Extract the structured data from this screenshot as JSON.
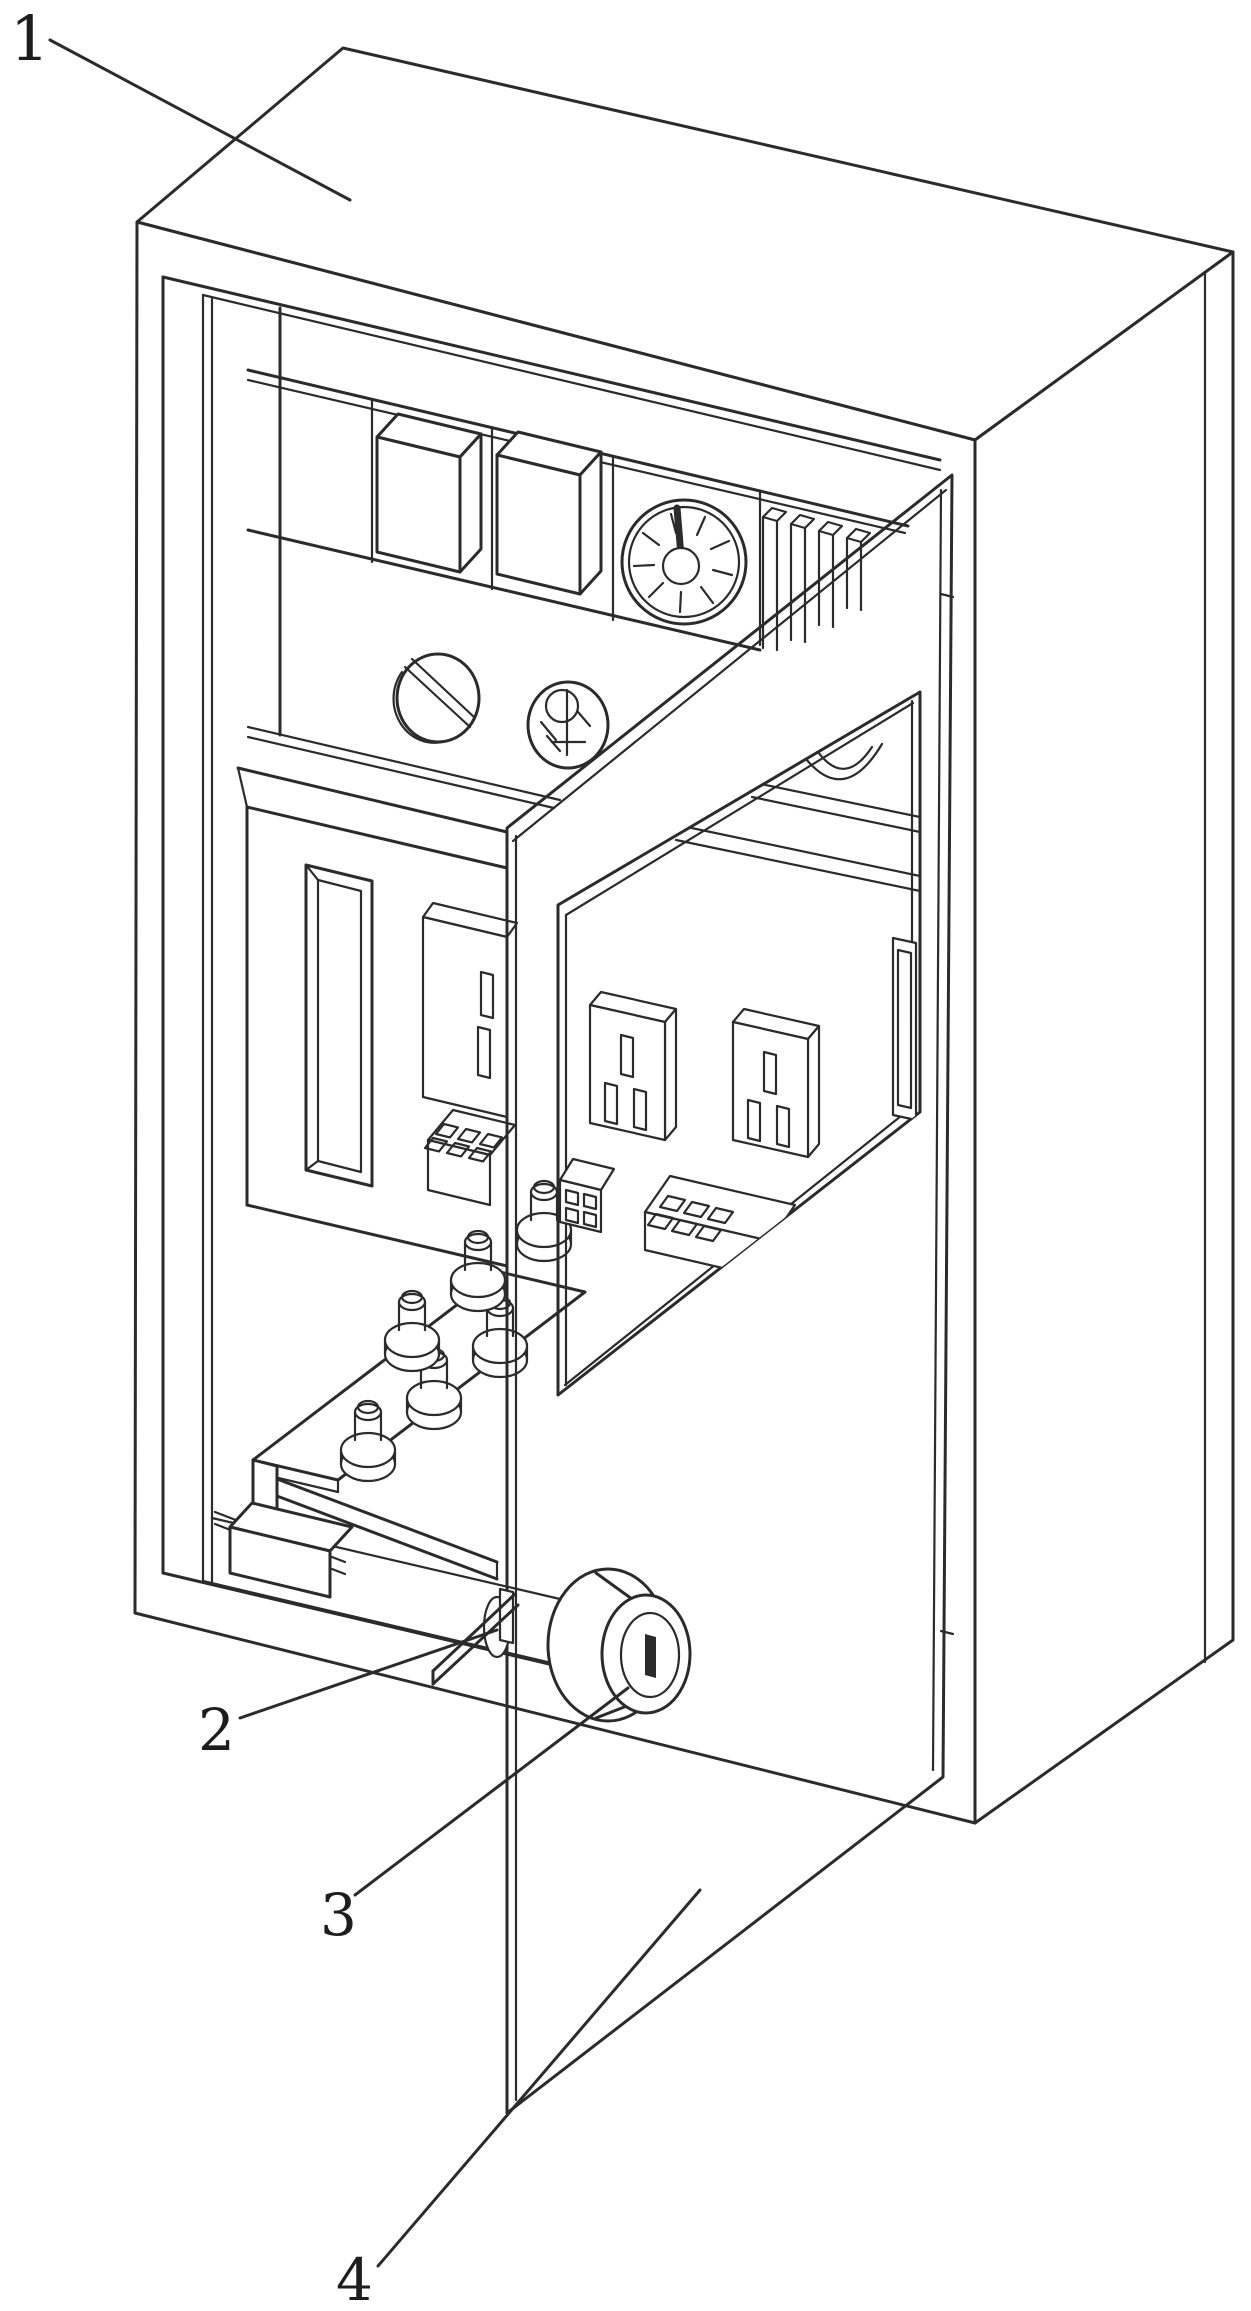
{
  "figure": {
    "background_color": "#ffffff",
    "line_color": "#2b2b2b",
    "labels": [
      {
        "text": "1"
      },
      {
        "text": "2"
      },
      {
        "text": "3"
      },
      {
        "text": "4"
      }
    ]
  }
}
